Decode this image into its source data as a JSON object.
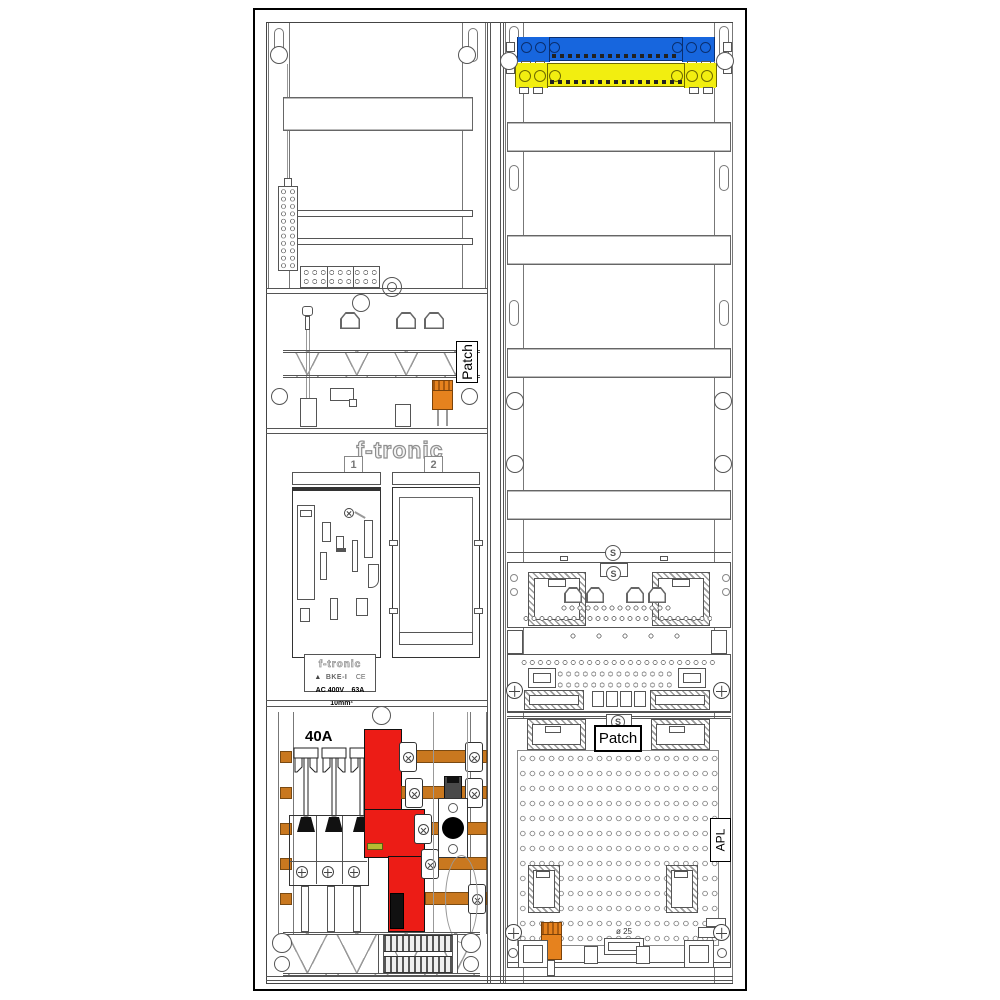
{
  "diagram": {
    "type": "electrical meter cabinet layout drawing",
    "brand": "f-tronic"
  },
  "left_column": {
    "hood_patch_label": "Patch",
    "meter_section": {
      "brand_logo": "f-tronic",
      "field_1": "1",
      "field_2": "2",
      "bke_plate": {
        "brand": "f-tronic",
        "logo_mark": "▲",
        "model": "BKE-I",
        "ce_mark": "CE",
        "voltage": "AC 400V",
        "current": "63A",
        "wire": "10mm²"
      }
    },
    "lower_section": {
      "breaker_rating": "40A"
    }
  },
  "right_column": {
    "patch_label": "Patch",
    "apl_label": "APL",
    "grommet_note": "ø 25"
  },
  "colors": {
    "neutral_busbar_blue": "#1766DE",
    "pe_busbar_yellow": "#F2EE10",
    "copper_busbar_orange": "#C9781F",
    "sls_switch_red": "#EC1C16",
    "connector_orange": "#E6821E",
    "seal_label_green": "#B5BD32"
  }
}
